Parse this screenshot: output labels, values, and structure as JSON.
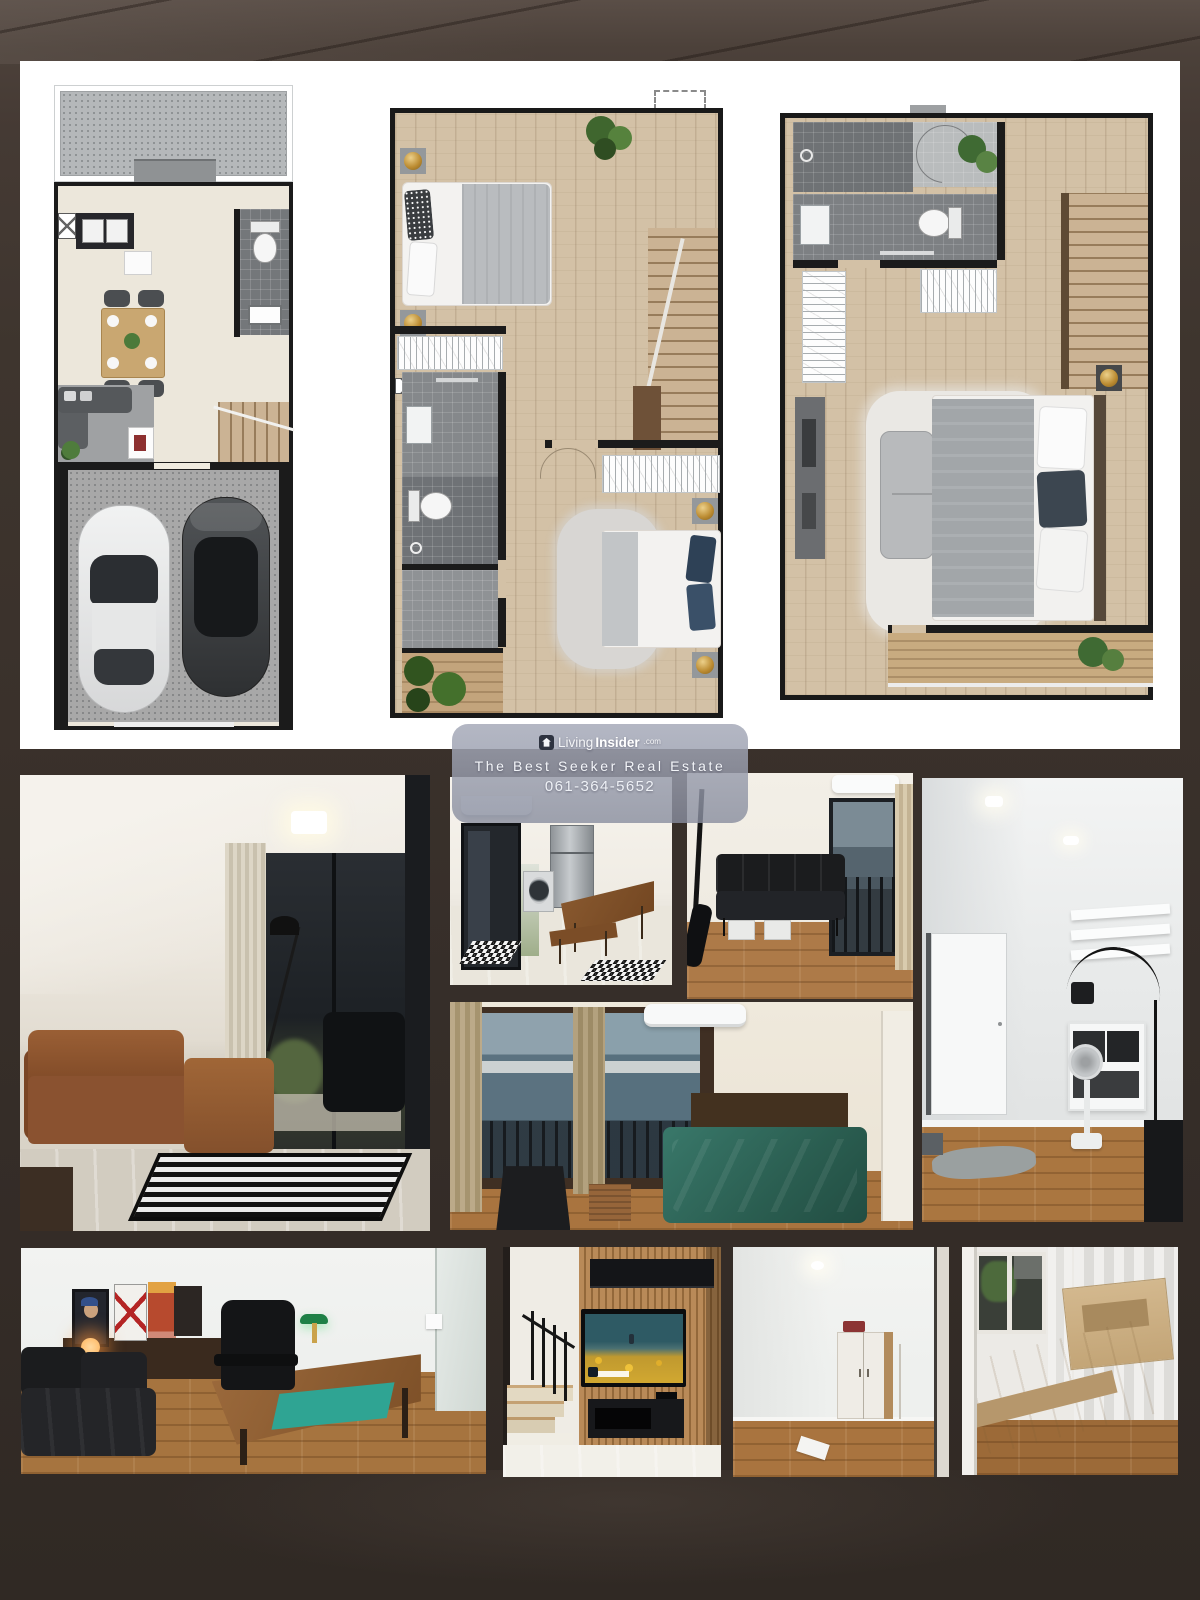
{
  "page": {
    "width": 1200,
    "height": 1600,
    "background_color": "#3a312b",
    "panel_color": "#ffffff"
  },
  "watermark": {
    "logo_icon": "living-insider-house-logo",
    "logo_light": "Living",
    "logo_bold": "Insider",
    "logo_suffix": ".com",
    "tagline": "The Best Seeker Real Estate",
    "phone": "061-364-5652",
    "box_color": "rgba(150,156,174,0.80)",
    "text_color": "#ffffff"
  },
  "floorplans": [
    {
      "id": "ground-floor",
      "areas": [
        "terrace",
        "kitchen",
        "wc",
        "dining",
        "living",
        "stairs",
        "garage-2-cars"
      ]
    },
    {
      "id": "second-floor",
      "areas": [
        "bedroom-1",
        "wardrobe",
        "bathroom",
        "wc",
        "hall",
        "stairs",
        "bedroom-2",
        "balcony-garden"
      ]
    },
    {
      "id": "third-floor",
      "areas": [
        "shower-room",
        "wc",
        "entry",
        "wardrobe",
        "built-in-closet",
        "stairs",
        "master-bedroom",
        "balcony"
      ]
    }
  ],
  "photos": [
    {
      "id": "living-room",
      "label": "living room with brown leather sofa and patterned rug"
    },
    {
      "id": "kitchen-dining",
      "label": "kitchen corner with fridge, washing machine and wooden dining set"
    },
    {
      "id": "day-bed-room",
      "label": "room with black day bed and balcony door"
    },
    {
      "id": "dressing-room",
      "label": "white room with wall shelves, arc lamp and stand fan"
    },
    {
      "id": "master-bedroom",
      "label": "bedroom with green bed and tall windows"
    },
    {
      "id": "home-office",
      "label": "office with black sofa, wooden desk and posters"
    },
    {
      "id": "tv-wall-stairs",
      "label": "slat TV wall beside staircase"
    },
    {
      "id": "wardrobe-room",
      "label": "empty room with wardrobe"
    },
    {
      "id": "wooden-bed-room",
      "label": "bedroom with light wooden bed frame"
    }
  ]
}
